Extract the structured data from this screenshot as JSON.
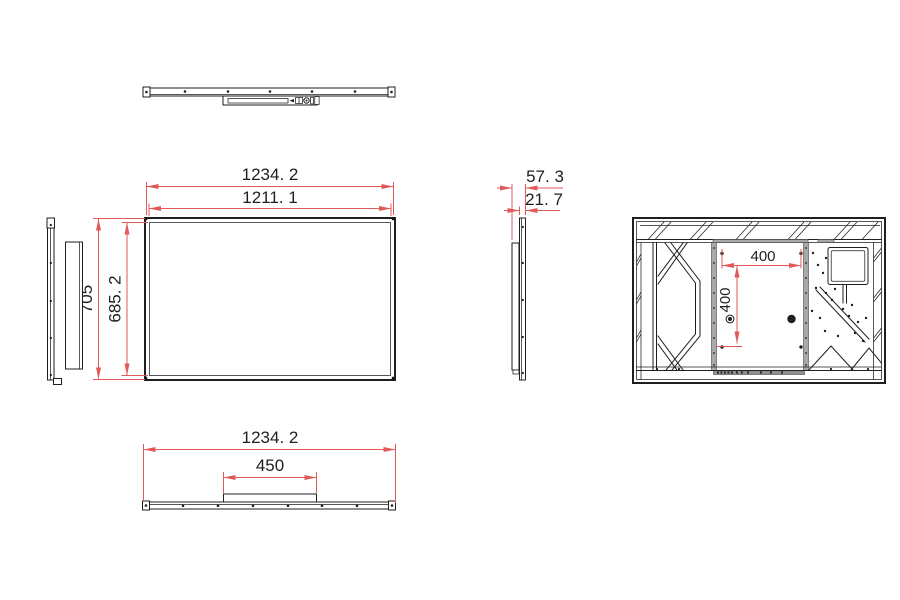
{
  "colors": {
    "dimension_red": "#e05a5a",
    "line_black": "#1f1f1f",
    "panel_gray": "#a9a9a9",
    "background": "#ffffff"
  },
  "dimensions": {
    "front_width_outer": "1234. 2",
    "front_width_inner": "1211. 1",
    "front_height_outer": "705",
    "front_height_inner": "685. 2",
    "side_depth_total": "57. 3",
    "side_panel_thickness": "21. 7",
    "vesa_width": "400",
    "vesa_height": "400",
    "bottom_width": "1234. 2",
    "bottom_bracket_width": "450"
  }
}
